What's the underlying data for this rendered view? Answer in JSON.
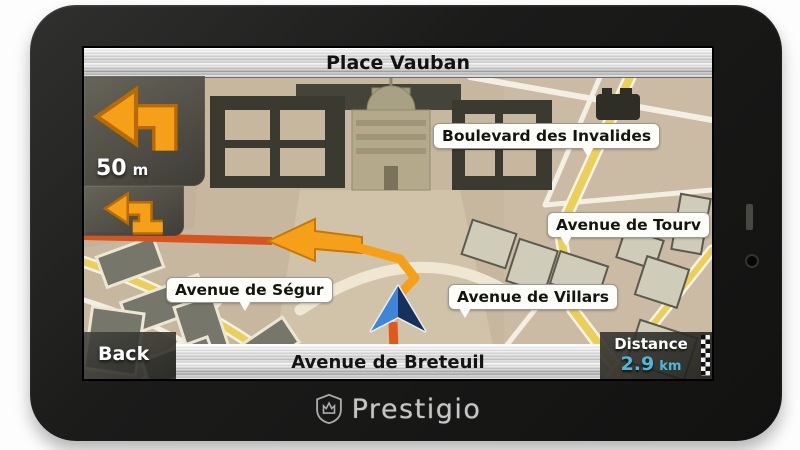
{
  "device": {
    "brand": "Prestigio",
    "logo_icon": "shield-crown-icon"
  },
  "top_bar": {
    "title": "Place Vauban"
  },
  "maneuver": {
    "icon": "turn-left-arrow-icon",
    "distance_value": "50",
    "distance_unit": "m",
    "next_icon": "turn-left-arrow-icon"
  },
  "bottom_bar": {
    "back_label": "Back",
    "current_street": "Avenue de Breteuil"
  },
  "distance_panel": {
    "label": "Distance",
    "value": "2.9",
    "unit": "km",
    "flag_icon": "checkered-flag-icon"
  },
  "map": {
    "labels": {
      "boulevard_des_invalides": "Boulevard des Invalides",
      "avenue_de_tourville": "Avenue de Tourv",
      "avenue_de_segur": "Avenue de Ségur",
      "avenue_de_villars": "Avenue de Villars"
    },
    "marker_icon": "current-position-arrow-icon"
  },
  "colors": {
    "accent_orange": "#F6A019",
    "route_red": "#DD531E",
    "distance_cyan": "#4DB8DC",
    "map_background": "#C7B79F",
    "road_yellow": "#EAD05A"
  }
}
